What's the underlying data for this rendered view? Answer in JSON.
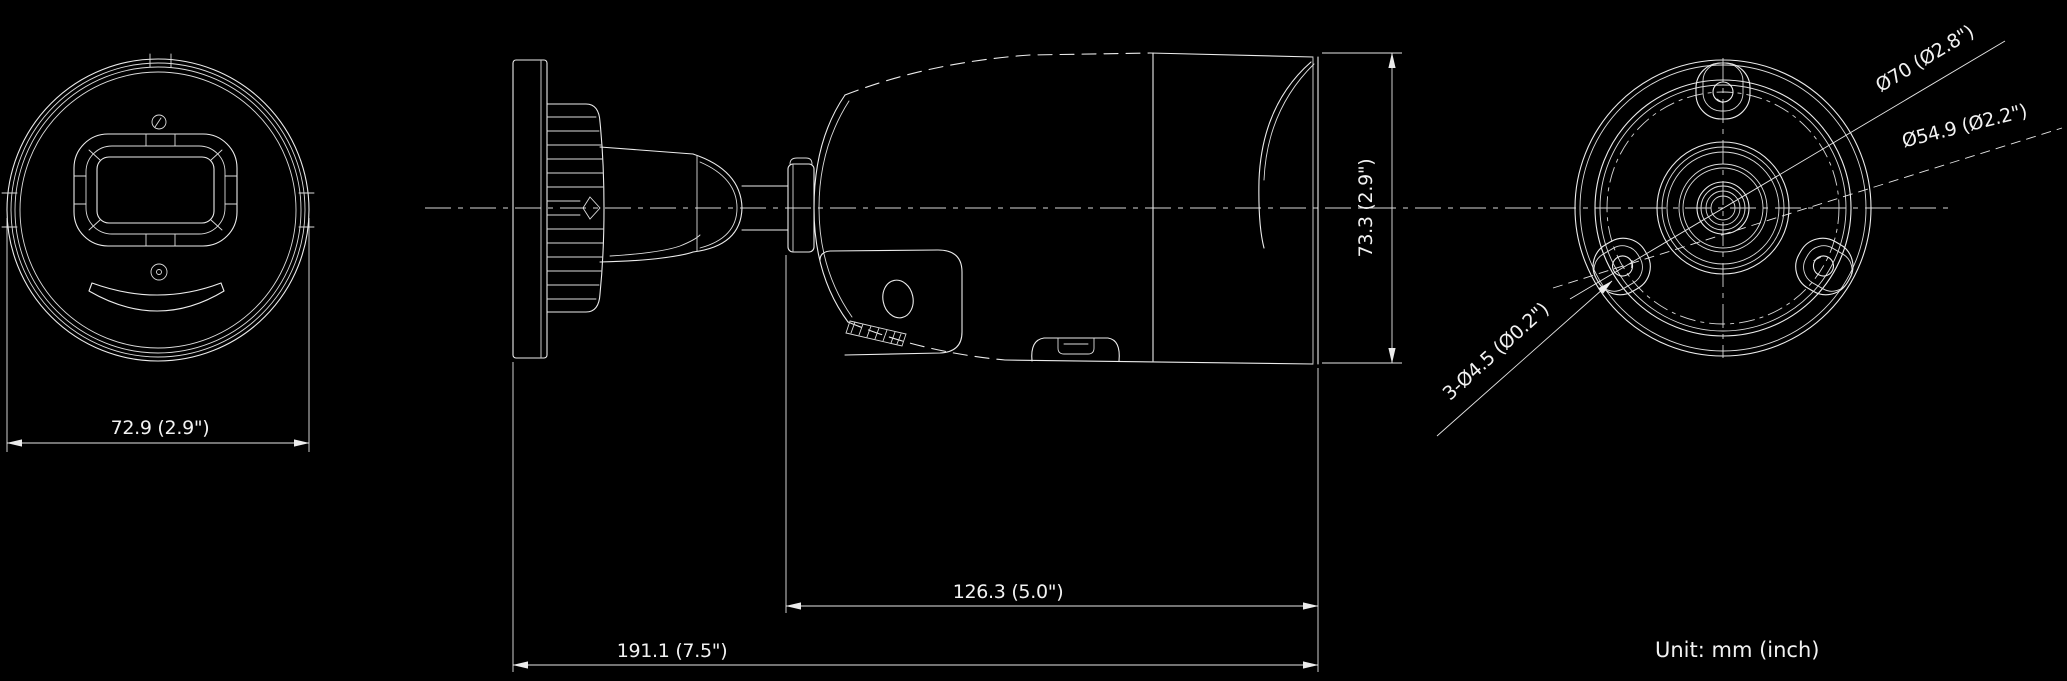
{
  "drawing": {
    "type": "technical-dimension-drawing",
    "subject": "bullet-camera",
    "views": [
      "front",
      "side",
      "back"
    ],
    "colors": {
      "background": "#000000",
      "line": "#ececec",
      "text": "#f2f2f2"
    }
  },
  "labels": {
    "front_width": "72.9 (2.9\")",
    "side_height": "73.3 (2.9\")",
    "side_front_length": "126.3 (5.0\")",
    "side_total_length": "191.1 (7.5\")",
    "back_outer_diameter": "Ø70 (Ø2.8\")",
    "back_mount_circle": "Ø54.9 (Ø2.2\")",
    "back_mount_holes": "3-Ø4.5 (Ø0.2\")",
    "unit_note": "Unit: mm (inch)"
  },
  "dimensions": {
    "front_width_mm": "72.9",
    "front_width_in": "2.9",
    "body_height_mm": "73.3",
    "body_height_in": "2.9",
    "front_section_length_mm": "126.3",
    "front_section_length_in": "5.0",
    "overall_length_mm": "191.1",
    "overall_length_in": "7.5",
    "base_outer_diameter_mm": "70",
    "base_outer_diameter_in": "2.8",
    "mount_hole_circle_mm": "54.9",
    "mount_hole_circle_in": "2.2",
    "mount_holes_count": "3",
    "mount_hole_diameter_mm": "4.5",
    "mount_hole_diameter_in": "0.2"
  }
}
